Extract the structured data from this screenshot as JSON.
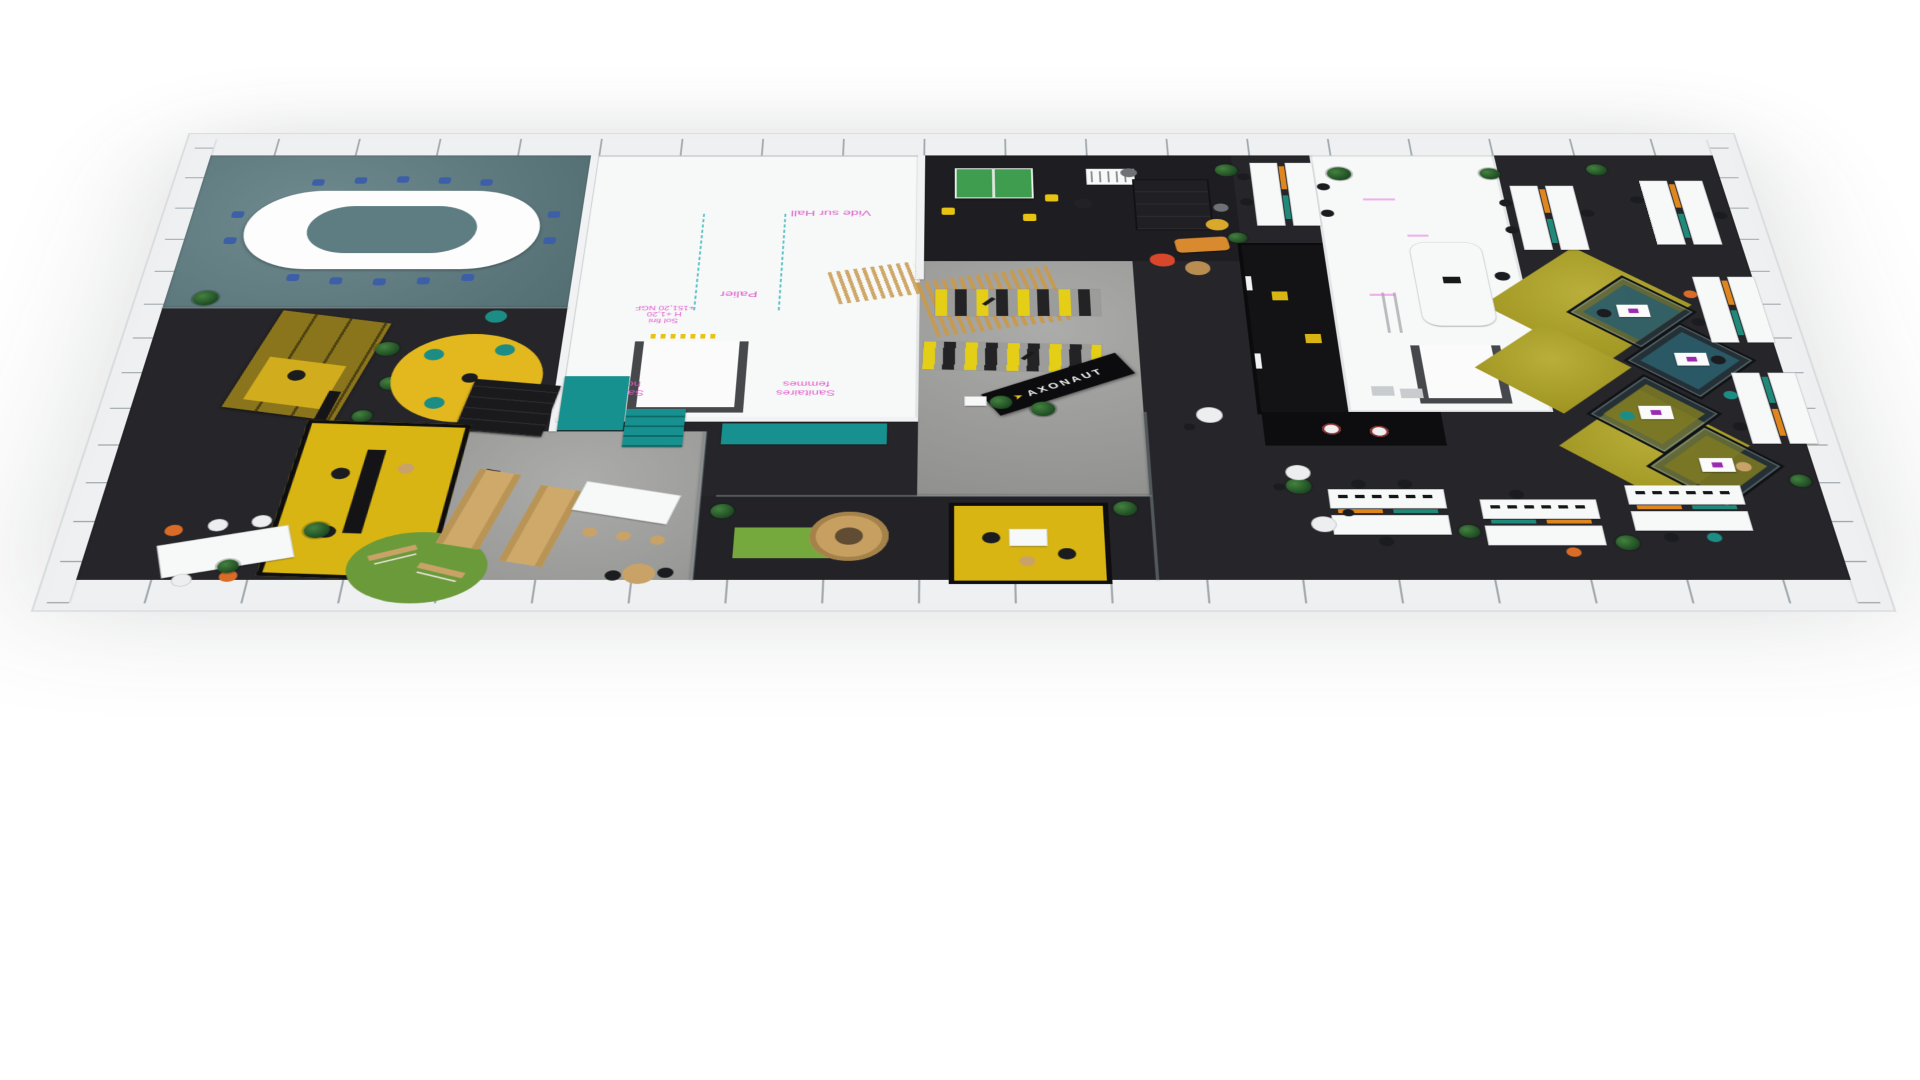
{
  "scene": {
    "description": "3D axonometric rendering of an office floor plan",
    "labels": {
      "vide_sur_hall": "Vide sur Hall",
      "palier": "Palier",
      "sol_fini_1": "Sol fini",
      "sol_fini_2": "H +1,20",
      "sol_fini_3": "+151,20 NGF",
      "sanitaires": "Sanitaires",
      "hommes": "hommes",
      "femmes": "femmes"
    },
    "brand": {
      "name": "AXONAUT",
      "mark": "➤"
    },
    "colors": {
      "carpet_dark": "#26262a",
      "boardroom_carpet": "#5e7d82",
      "concrete": "#a0a09e",
      "wall_white": "#f1f2f3",
      "accent_yellow": "#e3b71e",
      "accent_mustard": "#b1a524",
      "accent_teal": "#17918f",
      "accent_orange": "#da6c28",
      "chair_blue": "#3d5fa8",
      "grass_green": "#6a9a3a",
      "wood": "#c9a268",
      "label_pink": "#e05ccb",
      "pod_floor_teal": "#2b5f6d",
      "laptop_purple": "#9a2bb0"
    }
  }
}
